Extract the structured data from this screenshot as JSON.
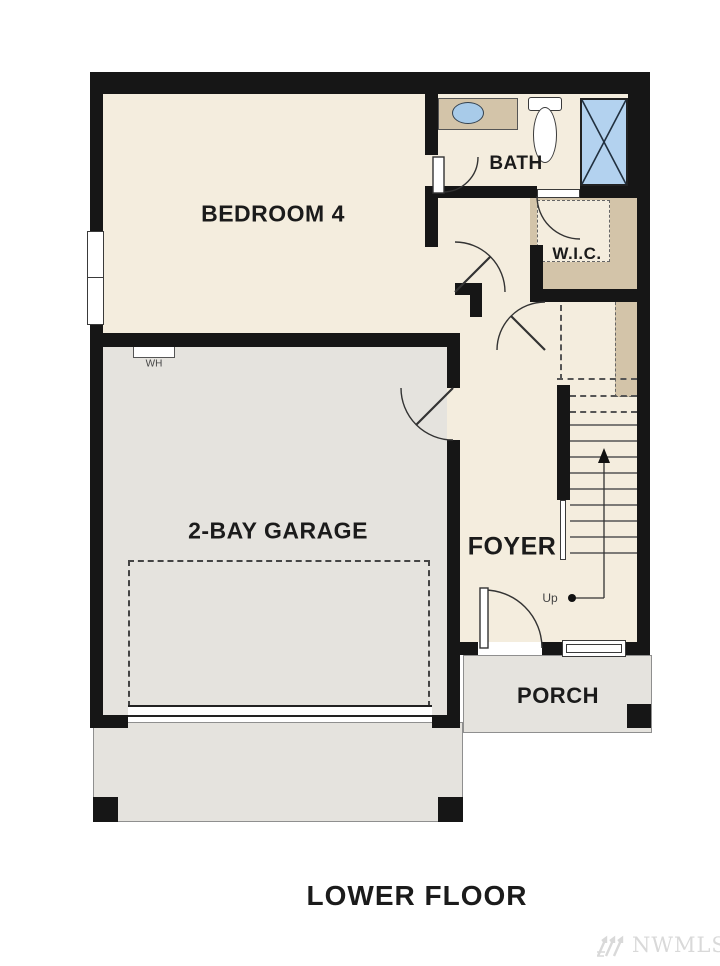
{
  "title": "LOWER FLOOR",
  "watermark": "NWMLS",
  "rooms": {
    "bedroom4": "BEDROOM 4",
    "bath": "BATH",
    "wic": "W.I.C.",
    "garage": "2-BAY GARAGE",
    "foyer": "FOYER",
    "porch": "PORCH"
  },
  "labels": {
    "water_heater": "WH",
    "stairs_up": "Up"
  },
  "colors": {
    "wall": "#161616",
    "room_fill": "#f4edde",
    "garage_fill": "#e5e3de",
    "cabinet_tan": "#d3c4a9",
    "fixture_blue": "#b3d2ef",
    "watermark_gray": "#d9d9d9"
  }
}
